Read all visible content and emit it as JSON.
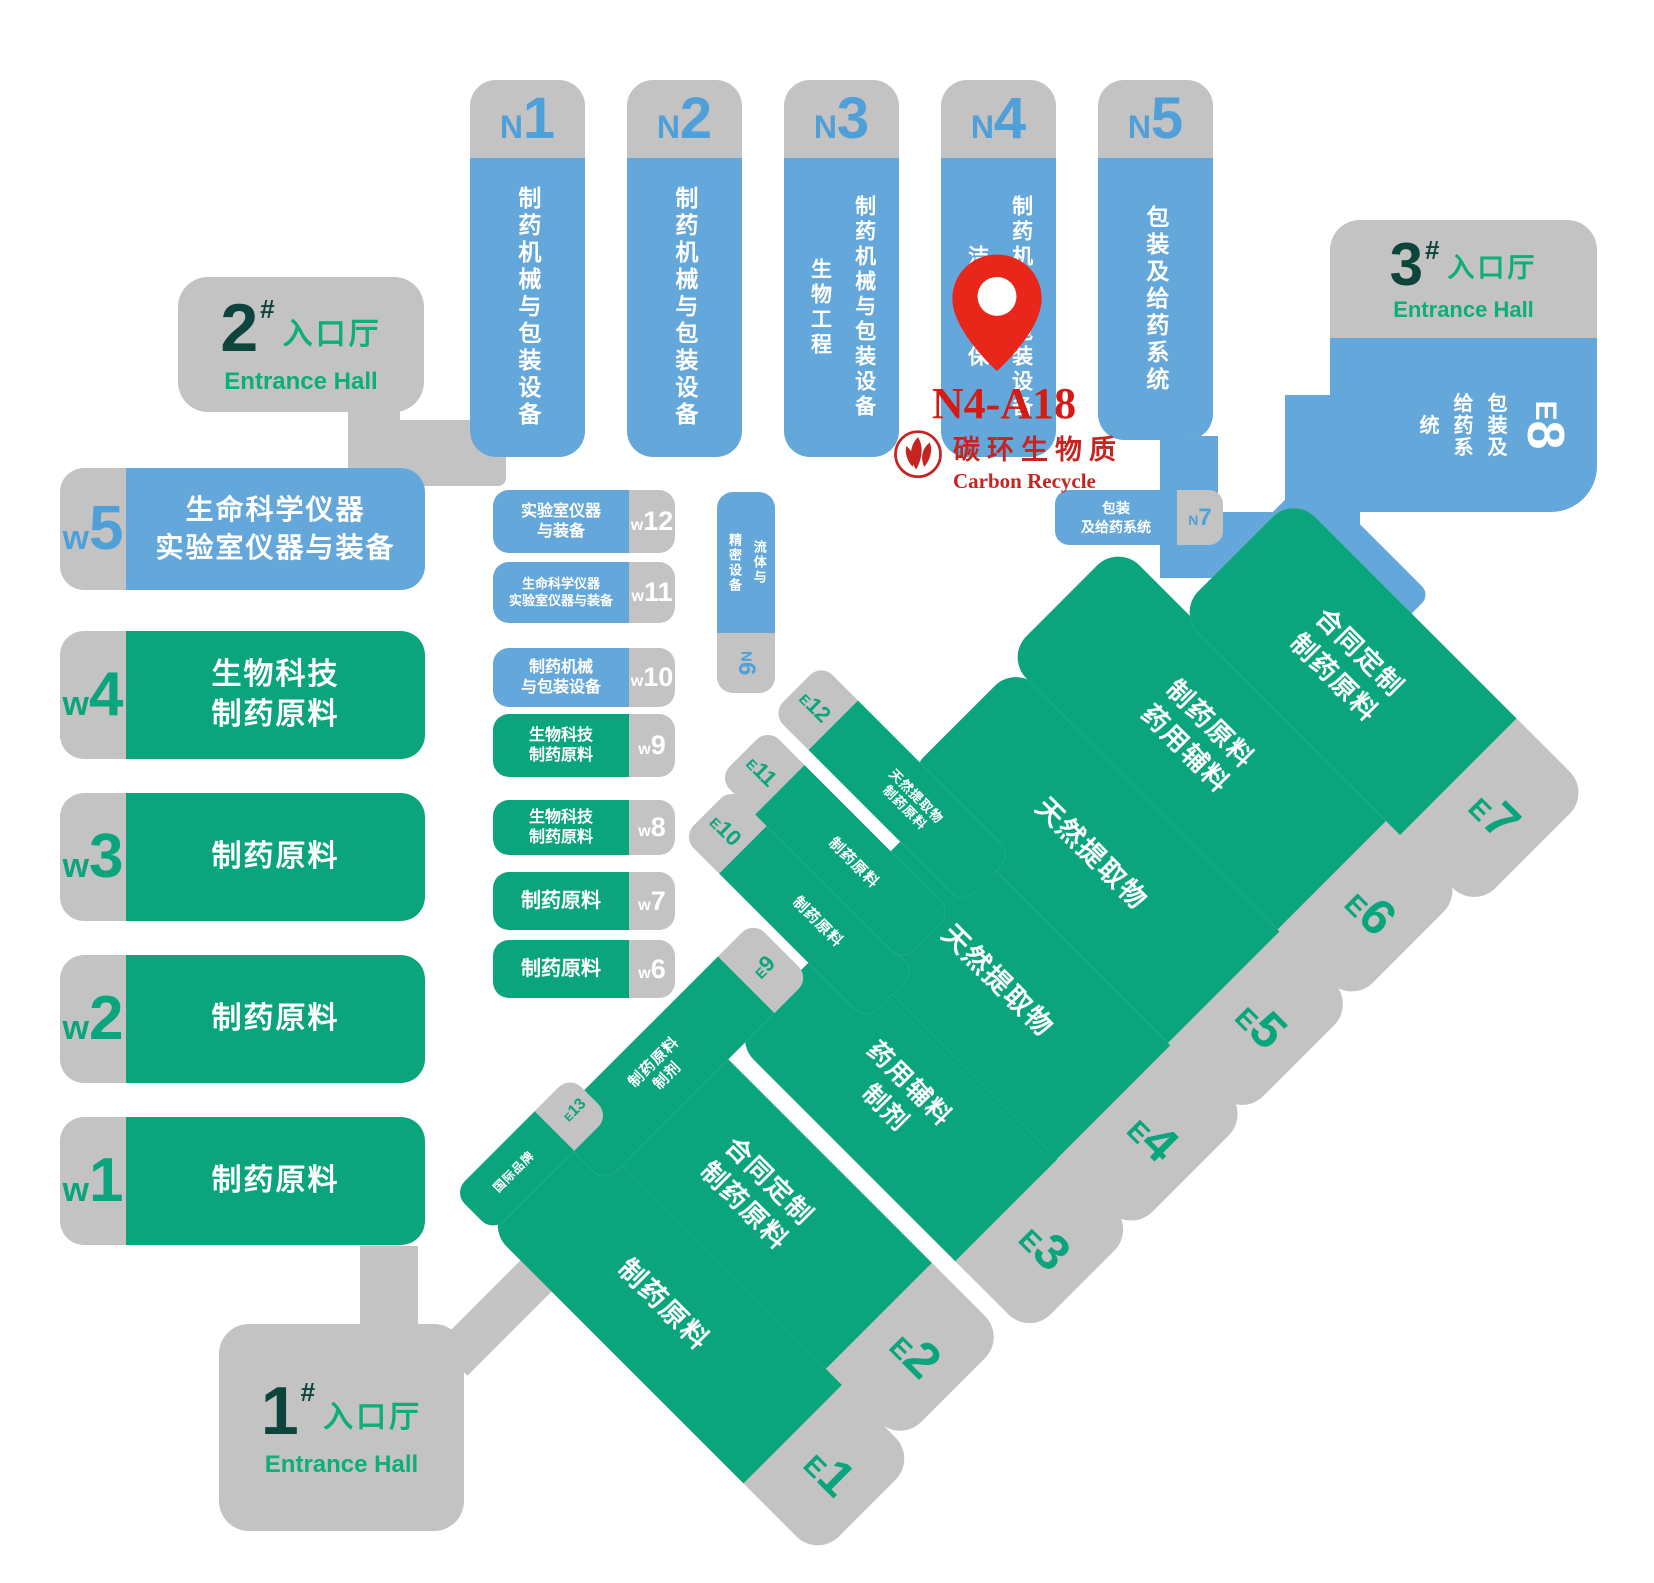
{
  "map": {
    "title": "Exhibition hall floor plan",
    "colors": {
      "hall_blue": "#64a7da",
      "hall_green": "#0aa57c",
      "corridor_gray": "#c3c3c3",
      "entrance_number": "#0d443c",
      "entrance_green": "#0cae79",
      "marker_red": "#e8261a",
      "logo_red": "#c62420"
    },
    "marker": {
      "booth": "N4-A18"
    },
    "logo": {
      "cn": "碳环生物质",
      "en": "Carbon Recycle"
    },
    "entrances": [
      {
        "num": "1",
        "hash": "#",
        "cn": "入口厅",
        "en": "Entrance Hall"
      },
      {
        "num": "2",
        "hash": "#",
        "cn": "入口厅",
        "en": "Entrance Hall"
      },
      {
        "num": "3",
        "hash": "#",
        "cn": "入口厅",
        "en": "Entrance Hall"
      }
    ],
    "north_halls": [
      {
        "letter": "N",
        "num": "1",
        "lines": [
          "制药机械与包装设备"
        ]
      },
      {
        "letter": "N",
        "num": "2",
        "lines": [
          "制药机械与包装设备"
        ]
      },
      {
        "letter": "N",
        "num": "3",
        "lines": [
          "制药机械与包装设备",
          "生物工程"
        ]
      },
      {
        "letter": "N",
        "num": "4",
        "lines": [
          "制药机械与包装设备",
          "洁净与环保"
        ]
      },
      {
        "letter": "N",
        "num": "5",
        "lines": [
          "包装及给药系统"
        ]
      }
    ],
    "west_halls": [
      {
        "letter": "w",
        "num": "5",
        "lines": [
          "生命科学仪器",
          "实验室仪器与装备"
        ]
      },
      {
        "letter": "w",
        "num": "4",
        "lines": [
          "生物科技",
          "制药原料"
        ]
      },
      {
        "letter": "w",
        "num": "3",
        "lines": [
          "制药原料"
        ]
      },
      {
        "letter": "w",
        "num": "2",
        "lines": [
          "制药原料"
        ]
      },
      {
        "letter": "w",
        "num": "1",
        "lines": [
          "制药原料"
        ]
      }
    ],
    "west_small_halls": [
      {
        "letter": "w",
        "num": "12",
        "lines": [
          "实验室仪器",
          "与装备"
        ]
      },
      {
        "letter": "w",
        "num": "11",
        "lines": [
          "生命科学仪器",
          "实验室仪器与装备"
        ]
      },
      {
        "letter": "w",
        "num": "10",
        "lines": [
          "制药机械",
          "与包装设备"
        ]
      },
      {
        "letter": "w",
        "num": "9",
        "lines": [
          "生物科技",
          "制药原料"
        ]
      },
      {
        "letter": "w",
        "num": "8",
        "lines": [
          "生物科技",
          "制药原料"
        ]
      },
      {
        "letter": "w",
        "num": "7",
        "lines": [
          "制药原料"
        ]
      },
      {
        "letter": "w",
        "num": "6",
        "lines": [
          "制药原料"
        ]
      }
    ],
    "mid_halls": [
      {
        "letter": "N",
        "num": "6",
        "lines": [
          "流体与",
          "精密设备"
        ]
      },
      {
        "letter": "N",
        "num": "7",
        "lines": [
          "包装",
          "及给药系统"
        ]
      }
    ],
    "east_halls": [
      {
        "letter": "E",
        "num": "1",
        "lines": [
          "制药原料"
        ]
      },
      {
        "letter": "E",
        "num": "2",
        "lines": [
          "合同定制",
          "制药原料"
        ]
      },
      {
        "letter": "E",
        "num": "3",
        "lines": [
          "药用辅料",
          "制剂"
        ]
      },
      {
        "letter": "E",
        "num": "4",
        "lines": [
          "天然提取物"
        ]
      },
      {
        "letter": "E",
        "num": "5",
        "lines": [
          "天然提取物"
        ]
      },
      {
        "letter": "E",
        "num": "6",
        "lines": [
          "制药原料",
          "药用辅料"
        ]
      },
      {
        "letter": "E",
        "num": "7",
        "lines": [
          "合同定制",
          "制药原料"
        ]
      },
      {
        "letter": "E",
        "num": "8",
        "lines": [
          "包装及",
          "给药系统"
        ]
      }
    ],
    "east_small_halls": [
      {
        "letter": "E",
        "num": "9",
        "lines": [
          "制药原料",
          "制剂"
        ]
      },
      {
        "letter": "E",
        "num": "10",
        "lines": [
          "制药原料"
        ]
      },
      {
        "letter": "E",
        "num": "11",
        "lines": [
          "制药原料"
        ]
      },
      {
        "letter": "E",
        "num": "12",
        "lines": [
          "天然提取物",
          "制药原料"
        ]
      },
      {
        "letter": "E",
        "num": "13",
        "lines": [
          "国际品牌"
        ]
      }
    ]
  }
}
